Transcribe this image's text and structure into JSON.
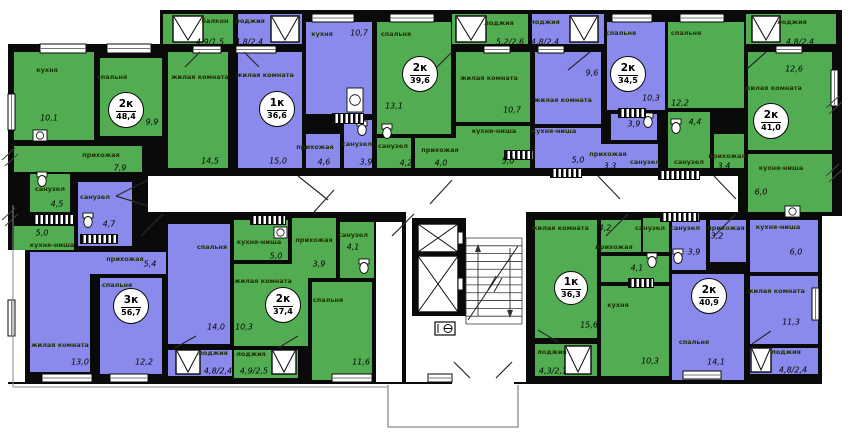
{
  "title": "Поэтажный план секции жилого дома",
  "palette": {
    "green": "#52ad52",
    "purple": "#8a8aec",
    "wall": "#0a0a0a",
    "floor": "#ffffff",
    "ground_line": "#8a8a8a",
    "door_line": "#2a2a2a"
  },
  "apartments": [
    {
      "type": "2к",
      "area": "48,4",
      "x": 126,
      "y": 110,
      "r": 17
    },
    {
      "type": "1к",
      "area": "36,6",
      "x": 277,
      "y": 109,
      "r": 17
    },
    {
      "type": "2к",
      "area": "39,6",
      "x": 420,
      "y": 74,
      "r": 17
    },
    {
      "type": "2к",
      "area": "34,5",
      "x": 628,
      "y": 74,
      "r": 17
    },
    {
      "type": "2к",
      "area": "41,0",
      "x": 771,
      "y": 121,
      "r": 17
    },
    {
      "type": "3к",
      "area": "56,7",
      "x": 131,
      "y": 306,
      "r": 17
    },
    {
      "type": "2к",
      "area": "37,4",
      "x": 283,
      "y": 305,
      "r": 17
    },
    {
      "type": "1к",
      "area": "36,3",
      "x": 571,
      "y": 288,
      "r": 16
    },
    {
      "type": "2к",
      "area": "40,9",
      "x": 709,
      "y": 296,
      "r": 17
    }
  ],
  "silhouette": [
    [
      8,
      44,
      834,
      340
    ],
    [
      160,
      10,
      682,
      36
    ]
  ],
  "whites": [
    [
      148,
      176,
      590,
      36
    ],
    [
      406,
      212,
      120,
      170
    ],
    [
      376,
      222,
      26,
      160
    ],
    [
      822,
      216,
      28,
      168
    ],
    [
      8,
      250,
      17,
      132
    ],
    [
      452,
      372,
      62,
      12
    ]
  ],
  "rooms": [
    [
      163,
      14,
      70,
      30,
      "g"
    ],
    [
      14,
      52,
      80,
      88,
      "g"
    ],
    [
      100,
      58,
      62,
      78,
      "g"
    ],
    [
      168,
      52,
      60,
      116,
      "g"
    ],
    [
      14,
      146,
      128,
      26,
      "g"
    ],
    [
      30,
      174,
      40,
      38,
      "g"
    ],
    [
      14,
      226,
      60,
      24,
      "g"
    ],
    [
      238,
      14,
      64,
      30,
      "p"
    ],
    [
      238,
      52,
      64,
      116,
      "p"
    ],
    [
      306,
      22,
      66,
      92,
      "p"
    ],
    [
      306,
      134,
      34,
      34,
      "p"
    ],
    [
      344,
      120,
      28,
      48,
      "p"
    ],
    [
      452,
      14,
      76,
      30,
      "g"
    ],
    [
      377,
      22,
      74,
      112,
      "g"
    ],
    [
      456,
      52,
      74,
      70,
      "g"
    ],
    [
      456,
      126,
      74,
      42,
      "g"
    ],
    [
      377,
      138,
      34,
      30,
      "g"
    ],
    [
      415,
      138,
      42,
      30,
      "g"
    ],
    [
      532,
      14,
      72,
      30,
      "p"
    ],
    [
      535,
      52,
      66,
      72,
      "p"
    ],
    [
      535,
      128,
      66,
      40,
      "p"
    ],
    [
      607,
      22,
      58,
      88,
      "p"
    ],
    [
      611,
      114,
      46,
      26,
      "p"
    ],
    [
      600,
      144,
      58,
      24,
      "p"
    ],
    [
      746,
      14,
      90,
      30,
      "g"
    ],
    [
      668,
      22,
      76,
      86,
      "g"
    ],
    [
      668,
      112,
      42,
      56,
      "g"
    ],
    [
      714,
      134,
      30,
      34,
      "g"
    ],
    [
      748,
      52,
      84,
      98,
      "g"
    ],
    [
      748,
      154,
      84,
      58,
      "g"
    ],
    [
      78,
      182,
      54,
      64,
      "p"
    ],
    [
      78,
      252,
      88,
      22,
      "p"
    ],
    [
      30,
      252,
      60,
      120,
      "p"
    ],
    [
      100,
      278,
      62,
      96,
      "p"
    ],
    [
      168,
      224,
      62,
      120,
      "p"
    ],
    [
      168,
      350,
      64,
      26,
      "p"
    ],
    [
      234,
      350,
      64,
      28,
      "g"
    ],
    [
      234,
      220,
      54,
      40,
      "g"
    ],
    [
      234,
      264,
      74,
      82,
      "g"
    ],
    [
      292,
      218,
      44,
      60,
      "g"
    ],
    [
      340,
      222,
      34,
      56,
      "g"
    ],
    [
      312,
      282,
      60,
      98,
      "g"
    ],
    [
      535,
      220,
      62,
      118,
      "g"
    ],
    [
      535,
      344,
      62,
      32,
      "g"
    ],
    [
      601,
      220,
      40,
      32,
      "g"
    ],
    [
      643,
      218,
      26,
      34,
      "g"
    ],
    [
      601,
      256,
      68,
      26,
      "g"
    ],
    [
      601,
      286,
      68,
      90,
      "g"
    ],
    [
      672,
      220,
      34,
      50,
      "p"
    ],
    [
      710,
      220,
      36,
      42,
      "p"
    ],
    [
      750,
      220,
      68,
      52,
      "p"
    ],
    [
      750,
      276,
      68,
      68,
      "p"
    ],
    [
      672,
      274,
      72,
      106,
      "p"
    ],
    [
      750,
      348,
      68,
      26,
      "p"
    ]
  ],
  "room_names": [
    [
      "кухня",
      47,
      70
    ],
    [
      "спальня",
      112,
      77
    ],
    [
      "жилая комната",
      200,
      77
    ],
    [
      "прихожая",
      101,
      155
    ],
    [
      "санузел",
      50,
      189
    ],
    [
      "кухня-ниша",
      52,
      245
    ],
    [
      "балкон",
      215,
      21
    ],
    [
      "лоджия",
      250,
      21
    ],
    [
      "жилая комната",
      265,
      75
    ],
    [
      "кухня",
      322,
      34
    ],
    [
      "прихожая",
      315,
      147
    ],
    [
      "санузел",
      357,
      144
    ],
    [
      "спальня",
      396,
      34
    ],
    [
      "жилая комната",
      489,
      78
    ],
    [
      "кухня-ниша",
      494,
      131
    ],
    [
      "санузел",
      393,
      146
    ],
    [
      "прихожая",
      440,
      150
    ],
    [
      "лоджия",
      499,
      23
    ],
    [
      "лоджия",
      545,
      22
    ],
    [
      "жилая комната",
      563,
      100
    ],
    [
      "кухня-ниша",
      554,
      131
    ],
    [
      "спальня",
      621,
      33
    ],
    [
      "санузел",
      645,
      162
    ],
    [
      "прихожая",
      608,
      154
    ],
    [
      "спальня",
      686,
      33
    ],
    [
      "санузел",
      689,
      162
    ],
    [
      "прихожая",
      727,
      156
    ],
    [
      "жилая комната",
      773,
      88
    ],
    [
      "кухня-ниша",
      781,
      168
    ],
    [
      "лоджия",
      792,
      22
    ],
    [
      "санузел",
      95,
      197
    ],
    [
      "прихожая",
      125,
      259
    ],
    [
      "жилая комната",
      60,
      345
    ],
    [
      "спальня",
      117,
      285
    ],
    [
      "спальня",
      212,
      247
    ],
    [
      "лоджия",
      213,
      353
    ],
    [
      "кухня-ниша",
      259,
      242
    ],
    [
      "жилая комната",
      263,
      281
    ],
    [
      "прихожая",
      314,
      240
    ],
    [
      "санузел",
      353,
      235
    ],
    [
      "спальня",
      328,
      300
    ],
    [
      "лоджия",
      251,
      354
    ],
    [
      "жилая комната",
      560,
      228
    ],
    [
      "прихожая",
      614,
      247
    ],
    [
      "санузел",
      650,
      228
    ],
    [
      "кухня",
      618,
      305
    ],
    [
      "лоджия",
      552,
      352
    ],
    [
      "санузел",
      685,
      228
    ],
    [
      "прихожая",
      726,
      228
    ],
    [
      "кухня-ниша",
      778,
      227
    ],
    [
      "жилая комната",
      776,
      291
    ],
    [
      "спальня",
      694,
      342
    ],
    [
      "лоджия",
      786,
      352
    ]
  ],
  "room_values": [
    [
      "10,1",
      49,
      118
    ],
    [
      "9,9",
      152,
      122
    ],
    [
      "14,5",
      210,
      161
    ],
    [
      "7,9",
      120,
      168
    ],
    [
      "4,5",
      57,
      204
    ],
    [
      "5,0",
      42,
      233
    ],
    [
      "4,9/1,5",
      210,
      42
    ],
    [
      "4,8/2,4",
      249,
      42
    ],
    [
      "15,0",
      278,
      161
    ],
    [
      "10,7",
      359,
      33
    ],
    [
      "4,6",
      324,
      162
    ],
    [
      "3,9",
      366,
      162
    ],
    [
      "13,1",
      394,
      106
    ],
    [
      "10,7",
      512,
      110
    ],
    [
      "5,0",
      508,
      161
    ],
    [
      "4,2",
      406,
      163
    ],
    [
      "4,0",
      441,
      163
    ],
    [
      "5,2/2,6",
      510,
      42
    ],
    [
      "4,8/2,4",
      545,
      42
    ],
    [
      "9,6",
      592,
      73
    ],
    [
      "5,0",
      578,
      160
    ],
    [
      "10,3",
      651,
      98
    ],
    [
      "3,9",
      634,
      124
    ],
    [
      "3,3",
      610,
      166
    ],
    [
      "12,2",
      680,
      103
    ],
    [
      "4,4",
      695,
      122
    ],
    [
      "3,4",
      724,
      166
    ],
    [
      "12,6",
      794,
      69
    ],
    [
      "6,0",
      761,
      192
    ],
    [
      "4,8/2,4",
      800,
      42
    ],
    [
      "4,7",
      109,
      224
    ],
    [
      "5,4",
      150,
      264
    ],
    [
      "13,0",
      80,
      362
    ],
    [
      "12,2",
      144,
      362
    ],
    [
      "14,0",
      216,
      327
    ],
    [
      "4,8/2,4",
      218,
      371
    ],
    [
      "5,0",
      276,
      256
    ],
    [
      "10,3",
      244,
      327
    ],
    [
      "3,9",
      319,
      264
    ],
    [
      "4,1",
      353,
      247
    ],
    [
      "11,6",
      361,
      362
    ],
    [
      "4,9/2,5",
      254,
      371
    ],
    [
      "4,2",
      605,
      228
    ],
    [
      "4,1",
      637,
      268
    ],
    [
      "15,6",
      589,
      325
    ],
    [
      "10,3",
      650,
      361
    ],
    [
      "4,3/2,1",
      553,
      371
    ],
    [
      "3,9",
      694,
      252
    ],
    [
      "3,2",
      717,
      236
    ],
    [
      "6,0",
      796,
      252
    ],
    [
      "11,3",
      791,
      322
    ],
    [
      "14,1",
      716,
      362
    ],
    [
      "4,8/2,4",
      793,
      370
    ]
  ],
  "flat_windows": [
    [
      40,
      44,
      46,
      9
    ],
    [
      107,
      44,
      44,
      9
    ],
    [
      193,
      46,
      28,
      7
    ],
    [
      236,
      46,
      40,
      7
    ],
    [
      484,
      46,
      26,
      7
    ],
    [
      538,
      46,
      26,
      7
    ],
    [
      776,
      46,
      26,
      7
    ],
    [
      312,
      14,
      42,
      8
    ],
    [
      390,
      14,
      44,
      8
    ],
    [
      612,
      14,
      40,
      8
    ],
    [
      680,
      14,
      44,
      8
    ],
    [
      42,
      374,
      50,
      8
    ],
    [
      110,
      374,
      38,
      8
    ],
    [
      332,
      374,
      40,
      8
    ],
    [
      428,
      374,
      24,
      8
    ],
    [
      683,
      371,
      38,
      8
    ],
    [
      8,
      94,
      7,
      36
    ],
    [
      8,
      300,
      7,
      36
    ],
    [
      831,
      70,
      7,
      36
    ],
    [
      812,
      288,
      7,
      32
    ]
  ],
  "v_windows": [
    [
      173,
      16,
      30,
      26
    ],
    [
      271,
      16,
      28,
      26
    ],
    [
      456,
      16,
      30,
      26
    ],
    [
      570,
      16,
      28,
      26
    ],
    [
      752,
      16,
      28,
      26
    ],
    [
      176,
      350,
      24,
      24
    ],
    [
      272,
      350,
      24,
      24
    ],
    [
      565,
      346,
      26,
      28
    ],
    [
      751,
      348,
      20,
      24
    ]
  ],
  "stripes": [
    [
      32,
      214,
      40,
      9
    ],
    [
      332,
      113,
      30,
      9
    ],
    [
      504,
      150,
      28,
      8
    ],
    [
      618,
      108,
      26,
      8
    ],
    [
      550,
      168,
      30,
      8
    ],
    [
      658,
      170,
      40,
      8
    ],
    [
      660,
      212,
      38,
      8
    ],
    [
      250,
      215,
      34,
      8
    ],
    [
      80,
      234,
      36,
      8
    ],
    [
      628,
      278,
      24,
      8
    ]
  ],
  "toilets": [
    [
      42,
      181
    ],
    [
      88,
      222
    ],
    [
      362,
      130
    ],
    [
      387,
      133
    ],
    [
      648,
      122
    ],
    [
      676,
      128
    ],
    [
      364,
      268
    ],
    [
      652,
      262
    ],
    [
      678,
      258
    ]
  ],
  "sinks": [
    [
      347,
      88,
      16,
      24
    ],
    [
      33,
      130,
      14,
      11
    ],
    [
      785,
      206,
      15,
      11
    ],
    [
      274,
      227,
      13,
      11
    ]
  ],
  "doors": [
    [
      148,
      180,
      116,
      196
    ],
    [
      148,
      206,
      116,
      196
    ],
    [
      298,
      176,
      328,
      200
    ],
    [
      430,
      204,
      452,
      180
    ],
    [
      598,
      176,
      620,
      199
    ],
    [
      714,
      176,
      736,
      199
    ],
    [
      736,
      214,
      714,
      236
    ],
    [
      628,
      214,
      606,
      236
    ],
    [
      414,
      214,
      392,
      236
    ],
    [
      314,
      212,
      334,
      190
    ],
    [
      163,
      214,
      141,
      236
    ],
    [
      470,
      378,
      454,
      362
    ],
    [
      496,
      378,
      512,
      362
    ],
    [
      200,
      52,
      185,
      67
    ],
    [
      244,
      52,
      259,
      67
    ],
    [
      452,
      52,
      436,
      68
    ],
    [
      590,
      52,
      568,
      70
    ],
    [
      766,
      52,
      747,
      69
    ],
    [
      175,
      348,
      196,
      336
    ],
    [
      278,
      348,
      298,
      336
    ],
    [
      558,
      342,
      538,
      330
    ],
    [
      752,
      344,
      771,
      331
    ]
  ],
  "elevators": {
    "block": [
      412,
      218,
      54,
      98
    ],
    "shafts": [
      [
        418,
        224,
        40,
        28
      ],
      [
        418,
        256,
        40,
        56
      ]
    ]
  },
  "stairs": {
    "x": 466,
    "y": 238,
    "w": 56,
    "h": 86,
    "steps": 12
  },
  "panel": {
    "x": 435,
    "y": 322,
    "w": 20,
    "h": 13,
    "symbol": "⊕"
  },
  "porch": [
    388,
    385,
    130,
    42
  ],
  "ground_lines": [
    [
      13,
      205,
      13,
      387
    ],
    [
      13,
      387,
      388,
      387
    ]
  ],
  "breaks": [
    [
      2,
      148
    ],
    [
      2,
      208
    ],
    [
      826,
      96
    ],
    [
      826,
      164
    ]
  ]
}
